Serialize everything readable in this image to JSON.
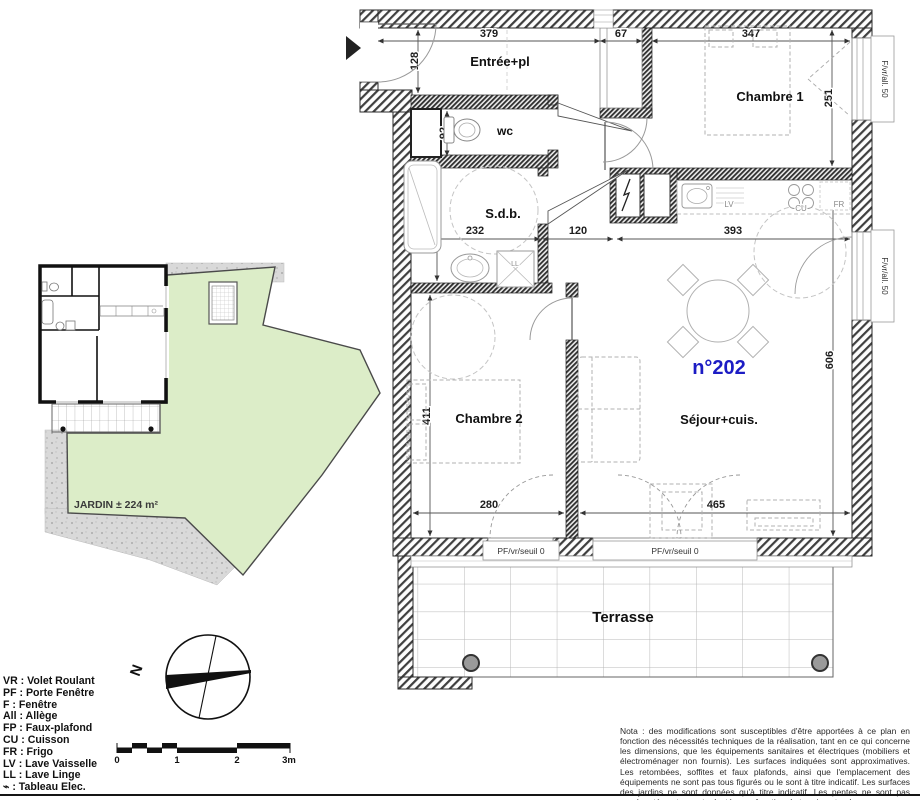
{
  "plan": {
    "unit_number": "n°202",
    "rooms": {
      "entree": "Entrée+pl",
      "wc": "wc",
      "sdb": "S.d.b.",
      "chambre1": "Chambre 1",
      "chambre2": "Chambre 2",
      "sejour": "Séjour+cuis.",
      "terrasse": "Terrasse"
    },
    "dims": {
      "entree_w": "379",
      "entree_h": "128",
      "placard_w": "67",
      "chambre1_w": "347",
      "chambre1_h": "251",
      "wc_h": "92",
      "sdb_h": "212",
      "sdb_w": "232",
      "hall_w": "120",
      "cuisine_w": "393",
      "chambre2_h": "411",
      "chambre2_w": "280",
      "sejour_w": "465",
      "sejour_h": "606"
    },
    "appliances": {
      "lv": "LV",
      "cu": "CU",
      "fr": "FR",
      "ll": "LL"
    },
    "windows": {
      "right_top": "F/vr/all. 50",
      "right_mid": "F/vr/all. 50",
      "bottom_left": "PF/vr/seuil 0",
      "bottom_right": "PF/vr/seuil 0"
    }
  },
  "site": {
    "garden_label": "JARDIN ± 224 m²"
  },
  "compass": {
    "north": "N"
  },
  "legend": {
    "items": [
      "VR : Volet Roulant",
      "PF : Porte Fenêtre",
      "F : Fenêtre",
      "All : Allège",
      "FP : Faux-plafond",
      "CU : Cuisson",
      "FR : Frigo",
      "LV : Lave Vaisselle",
      "LL : Lave Linge",
      "⌁ : Tableau Elec."
    ]
  },
  "scale_bar": {
    "ticks": [
      "0",
      "1",
      "2",
      "3m"
    ]
  },
  "colors": {
    "garden": "#dcedc8",
    "unit_number": "#1c1cc4"
  },
  "nota": "Nota : des modifications sont susceptibles d'être apportées à ce plan en fonction des nécessités techniques de la réalisation, tant en ce qui concerne les dimensions, que les équipements sanitaires et électriques (mobiliers et électroménager non fournis). Les surfaces indiquées sont approximatives. Les retombées, soffites et faux plafonds, ainsi que l'emplacement des équipements ne sont pas tous figurés ou le sont à titre indicatif. Les surfaces des jardins ne sont données qu'à titre indicatif. Les pentes ne sont pas représentées et seront adaptées en fonction du terrain naturel."
}
